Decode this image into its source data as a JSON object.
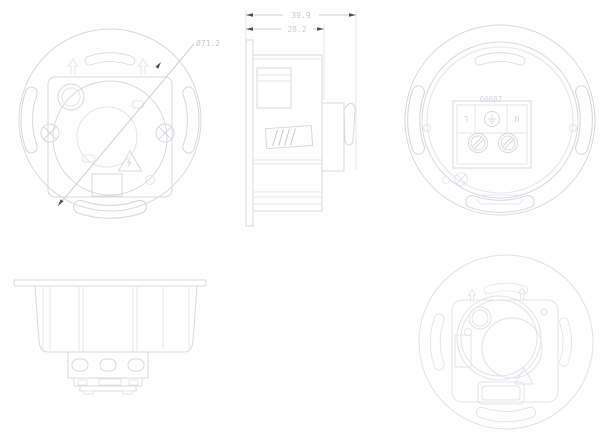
{
  "document": {
    "title": "flush-mount-sensor-technical-drawing",
    "background_color": "#ffffff",
    "line_color": "#d8dbdf",
    "light_line_color": "#e4e7ea",
    "dimension_text_color": "#c7cbd1",
    "arrowhead_color": "#4b4f54"
  },
  "views": {
    "front": {
      "diameter_dimension": "Ø71.2"
    },
    "side": {
      "overall_depth_dimension": "39.9",
      "recess_depth_dimension": "28.2"
    },
    "back": {
      "part_number": "00687",
      "terminal_live_label": "L",
      "terminal_neutral_label": "N"
    }
  },
  "icons": {
    "front_view": [
      "up-arrow-icon",
      "phillips-screw-icon",
      "warning-triangle-icon",
      "keyhole-icon"
    ],
    "back_view": [
      "earth-ground-icon",
      "terminal-screw-icon",
      "phillips-screw-icon"
    ],
    "isometric_view": [
      "up-arrow-icon",
      "warning-triangle-icon"
    ]
  }
}
